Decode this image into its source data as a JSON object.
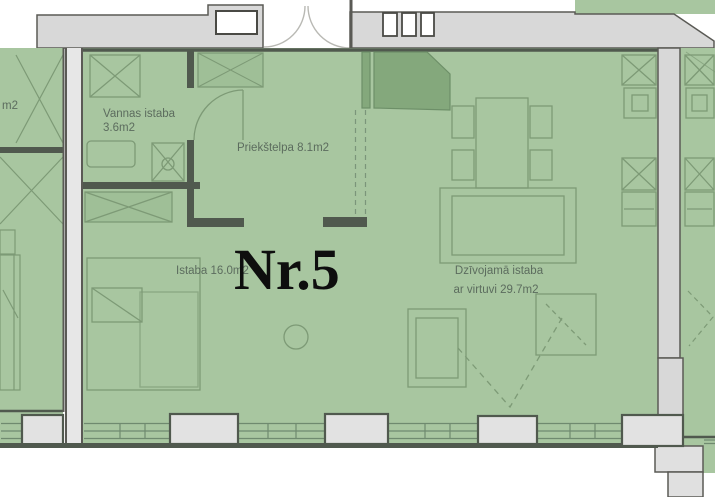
{
  "floor_plan": {
    "apartment_number": "Nr.5",
    "labels": {
      "bathroom_name": "Vannas istaba",
      "bathroom_area": "3.6m2",
      "hallway": "Priekštelpa 8.1m2",
      "room": "Istaba 16.0m2",
      "living_line1": "Dzīvojamā istaba",
      "living_line2": "ar virtuvi 29.7m2",
      "neighbor_left_area": "m2"
    },
    "colors": {
      "room_fill": "#a8c6a0",
      "closet_fill": "#9fbf97",
      "vestibule_dark_green": "#84a87c",
      "wall_band_fill": "#d8d8d8",
      "left_wall_fill": "#e7e7e7",
      "pier_fill": "#e2e2e2",
      "wall_outline": "#5a5a55",
      "interior_wall": "#50594e",
      "furniture_line": "#7d9a76",
      "label_text": "#5c6c5e",
      "apartment_number_text": "#0e0e0e",
      "background": "#ffffff"
    }
  }
}
